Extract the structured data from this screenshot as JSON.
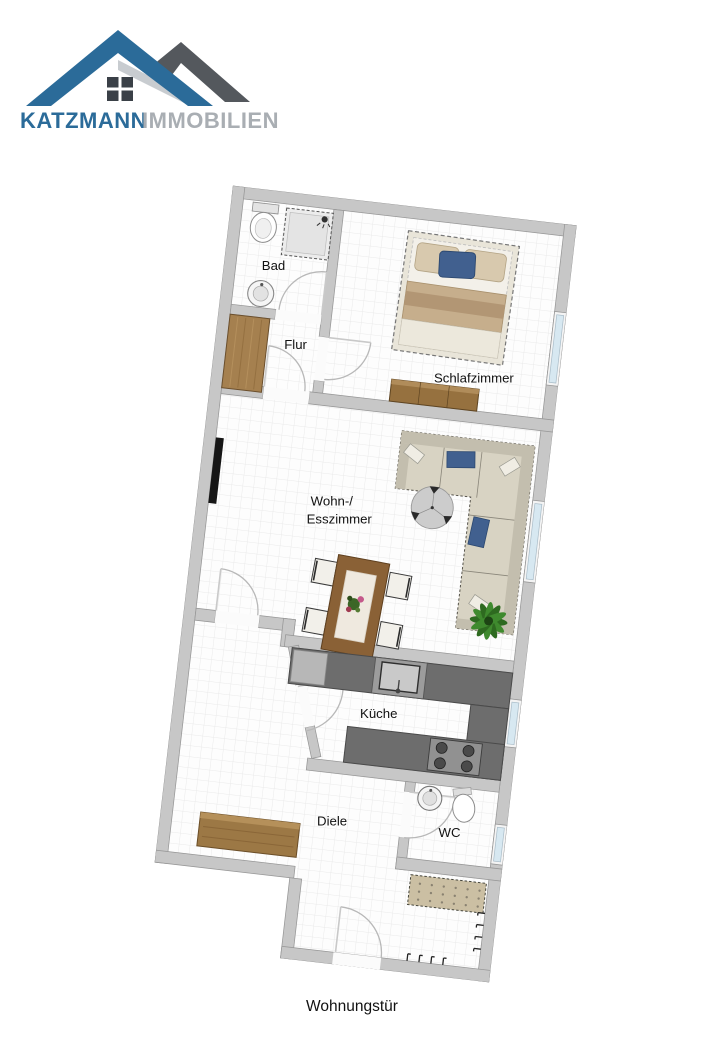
{
  "logo": {
    "brand": "KATZMANN",
    "suffix": "IMMOBILIEN",
    "colors": {
      "brand_blue": "#2b6b99",
      "roof_gray": "#54585d",
      "text_gray": "#a9aeb3",
      "window_dark": "#3a4047"
    }
  },
  "plan": {
    "rotation_deg": 6.6,
    "colors": {
      "wall": "#c7c7c7",
      "floor": "#fdfdfd",
      "grid": "#eaeaea",
      "window_glass": "#d7e8f1",
      "counter": "#6d6d6d",
      "wood": "#9c7845",
      "sofa_beige": "#d8d3c3",
      "cushion_blue": "#41608f",
      "plant_green": "#3f8a2e"
    },
    "rooms": {
      "bad": {
        "label": "Bad"
      },
      "flur": {
        "label": "Flur"
      },
      "schlafzimmer": {
        "label": "Schlafzimmer"
      },
      "wohn_esszimmer": {
        "label_line1": "Wohn-/",
        "label_line2": "Esszimmer"
      },
      "kueche": {
        "label": "Küche"
      },
      "diele": {
        "label": "Diele"
      },
      "wc": {
        "label": "WC"
      }
    },
    "entry_label": "Wohnungstür",
    "furniture": [
      "toilet",
      "shower",
      "washbasin",
      "wardrobe",
      "double-bed",
      "dresser",
      "corner-sofa",
      "side-table",
      "dining-table",
      "dining-chairs",
      "plant",
      "tv-lowboard",
      "kitchen-counter",
      "kitchen-sink",
      "stove",
      "wc-washbasin",
      "wc-toilet",
      "sideboard",
      "bench",
      "coat-hooks"
    ]
  }
}
